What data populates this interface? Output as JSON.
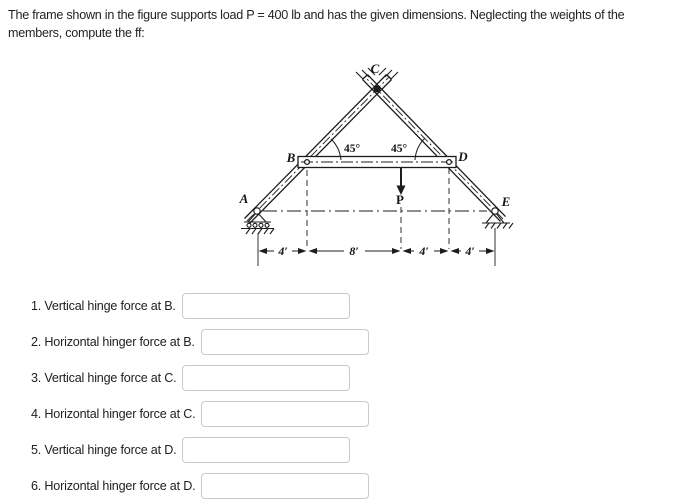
{
  "header": {
    "line1": "The frame shown in the figure supports load P = 400 lb and has the given dimensions. Neglecting the weights of the",
    "line2": "members, compute the ff:"
  },
  "figure": {
    "point_labels": {
      "A": "A",
      "B": "B",
      "C": "C",
      "D": "D",
      "E": "E"
    },
    "load_label": "P",
    "angle_left": "45°",
    "angle_right": "45°",
    "dim_labels": [
      "4′",
      "8′",
      "4′",
      "4′"
    ]
  },
  "questions": [
    {
      "label": "1. Vertical hinge force at B.",
      "value": ""
    },
    {
      "label": "2. Horizontal hinger force at B.",
      "value": ""
    },
    {
      "label": "3. Vertical hinge force at C.",
      "value": ""
    },
    {
      "label": "4. Horizontal hinger force at C.",
      "value": ""
    },
    {
      "label": "5. Vertical hinge force at D.",
      "value": ""
    },
    {
      "label": "6. Horizontal hinger force at D.",
      "value": ""
    }
  ]
}
